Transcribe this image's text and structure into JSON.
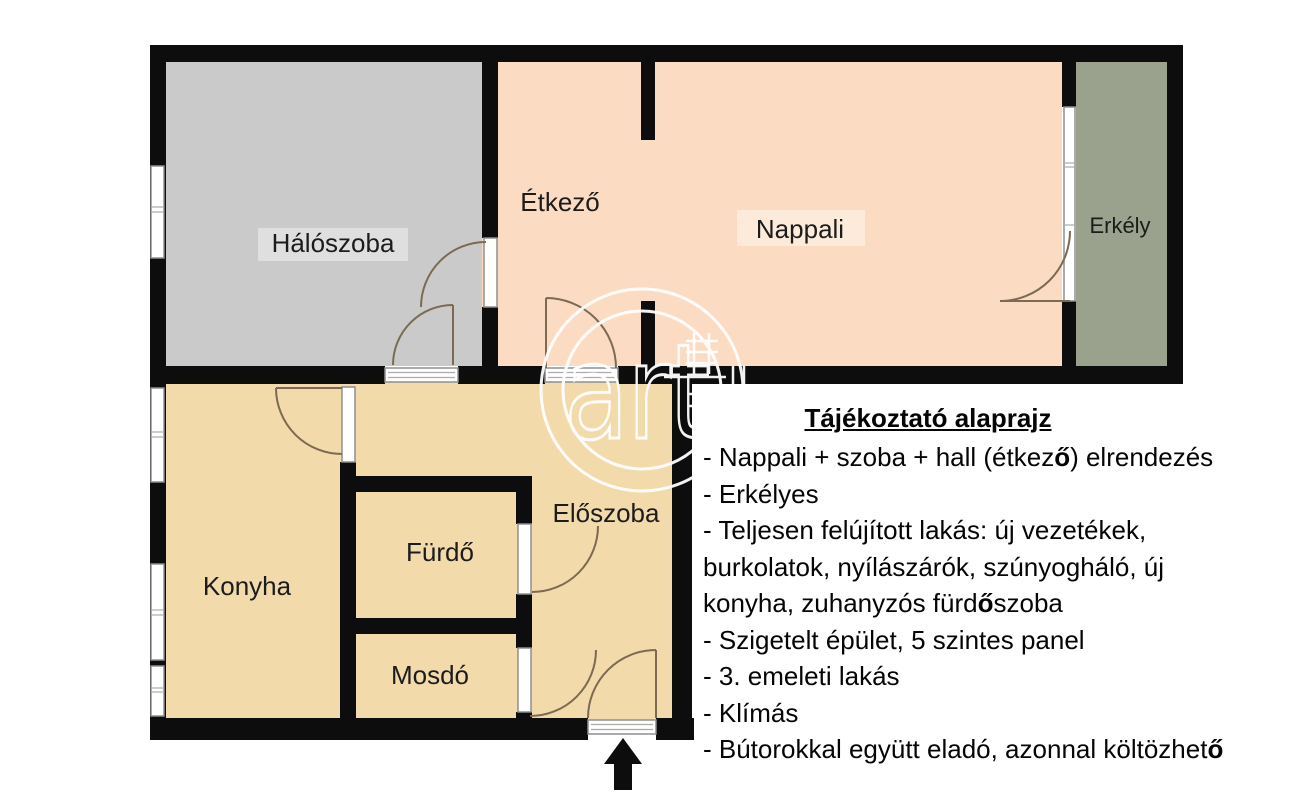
{
  "floorplan": {
    "rooms": [
      {
        "key": "haloszoba",
        "label": "Hálószoba"
      },
      {
        "key": "etkezo",
        "label": "Étkező"
      },
      {
        "key": "nappali",
        "label": "Nappali"
      },
      {
        "key": "erkely",
        "label": "Erkély"
      },
      {
        "key": "konyha",
        "label": "Konyha"
      },
      {
        "key": "furdo",
        "label": "Fürdő"
      },
      {
        "key": "mosdo",
        "label": "Mosdó"
      },
      {
        "key": "eloszoba",
        "label": "Előszoba"
      }
    ],
    "colors": {
      "wall": "#0d0d0d",
      "bedroom": "#cacaca",
      "living": "#fbdcc2",
      "balcony": "#9aa18d",
      "lower": "#f2daab",
      "swing": "#7d6a52"
    },
    "watermark_text": "art",
    "entrance_arrow": "up-arrow"
  },
  "notes": {
    "title": "Tájékoztató alaprajz",
    "lines": [
      "- Nappali + szoba + hall (étkező) elrendezés",
      "- Erkélyes",
      "- Teljesen felújított lakás: új vezetékek,",
      "burkolatok, nyílászárók, szúnyogháló, új",
      "konyha, zuhanyzós fürdőszoba",
      "- Szigetelt épület, 5 szintes panel",
      "- 3. emeleti lakás",
      "- Klímás",
      "- Bútorokkal együtt eladó, azonnal költözhető"
    ]
  }
}
